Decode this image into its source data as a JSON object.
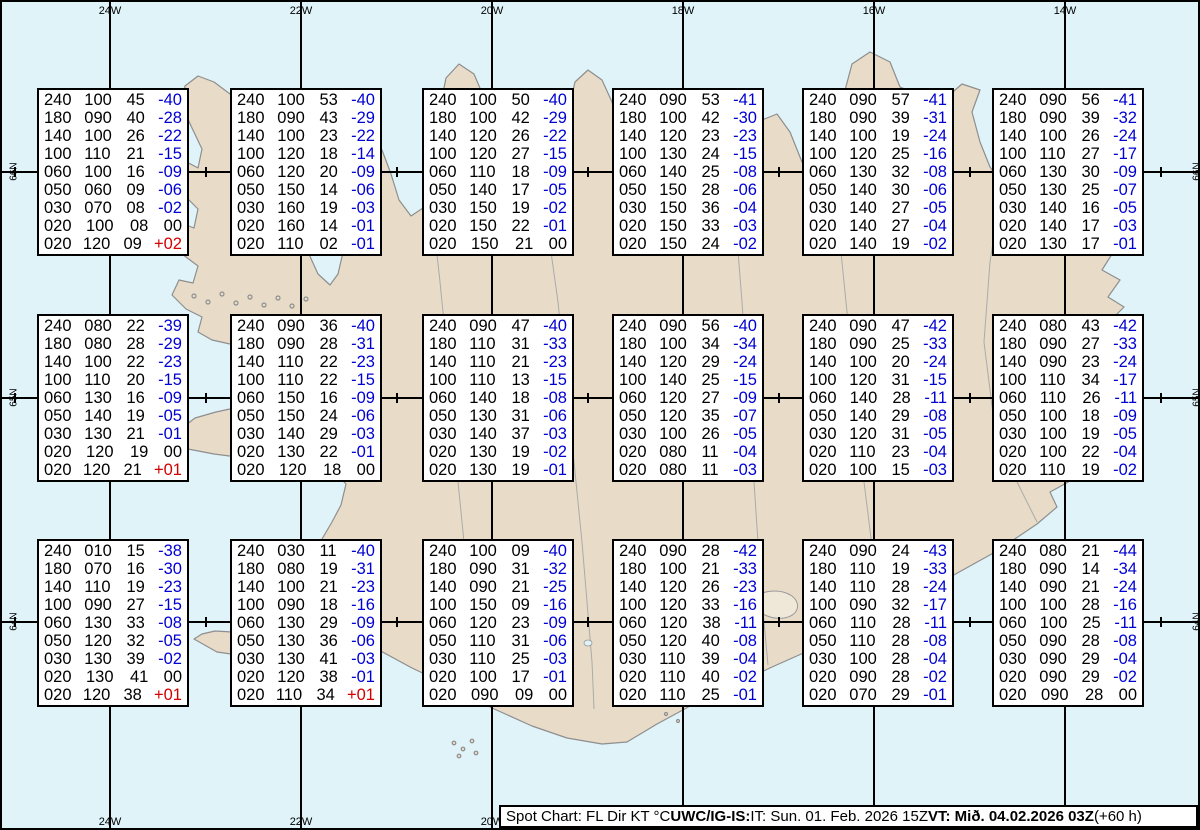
{
  "map": {
    "lon_labels": [
      "24W",
      "22W",
      "20W",
      "18W",
      "16W",
      "14W"
    ],
    "lat_labels": [
      "66N",
      "65N",
      "64N"
    ],
    "colors": {
      "sea": "#dff3f9",
      "land": "#e8dcc9",
      "coast": "#8e8e8e",
      "grid": "#000000",
      "temp_negative": "#0000d4",
      "temp_positive": "#d40000",
      "text": "#000000"
    }
  },
  "footer": {
    "segments": [
      {
        "text": "Spot Chart: FL Dir KT °C ",
        "bold": false
      },
      {
        "text": "UWC/IG-IS:",
        "bold": true
      },
      {
        "text": " IT: Sun. 01. Feb. 2026 15Z ",
        "bold": false
      },
      {
        "text": "VT: Mið. 04.02.2026 03Z",
        "bold": true
      },
      {
        "text": " (+60 h)",
        "bold": false
      }
    ]
  },
  "boxes": [
    {
      "rows": [
        [
          "240",
          "100",
          "45",
          "-40"
        ],
        [
          "180",
          "090",
          "40",
          "-28"
        ],
        [
          "140",
          "100",
          "26",
          "-22"
        ],
        [
          "100",
          "110",
          "21",
          "-15"
        ],
        [
          "060",
          "100",
          "16",
          "-09"
        ],
        [
          "050",
          "060",
          "09",
          "-06"
        ],
        [
          "030",
          "070",
          "08",
          "-02"
        ],
        [
          "020",
          "100",
          "08",
          "00"
        ],
        [
          "020",
          "120",
          "09",
          "+02"
        ]
      ]
    },
    {
      "rows": [
        [
          "240",
          "100",
          "53",
          "-40"
        ],
        [
          "180",
          "090",
          "43",
          "-29"
        ],
        [
          "140",
          "100",
          "23",
          "-22"
        ],
        [
          "100",
          "120",
          "18",
          "-14"
        ],
        [
          "060",
          "120",
          "20",
          "-09"
        ],
        [
          "050",
          "150",
          "14",
          "-06"
        ],
        [
          "030",
          "160",
          "19",
          "-03"
        ],
        [
          "020",
          "160",
          "14",
          "-01"
        ],
        [
          "020",
          "110",
          "02",
          "-01"
        ]
      ]
    },
    {
      "rows": [
        [
          "240",
          "100",
          "50",
          "-40"
        ],
        [
          "180",
          "100",
          "42",
          "-29"
        ],
        [
          "140",
          "120",
          "26",
          "-22"
        ],
        [
          "100",
          "120",
          "27",
          "-15"
        ],
        [
          "060",
          "110",
          "18",
          "-09"
        ],
        [
          "050",
          "140",
          "17",
          "-05"
        ],
        [
          "030",
          "150",
          "19",
          "-02"
        ],
        [
          "020",
          "150",
          "22",
          "-01"
        ],
        [
          "020",
          "150",
          "21",
          "00"
        ]
      ]
    },
    {
      "rows": [
        [
          "240",
          "090",
          "53",
          "-41"
        ],
        [
          "180",
          "100",
          "42",
          "-30"
        ],
        [
          "140",
          "120",
          "23",
          "-23"
        ],
        [
          "100",
          "130",
          "24",
          "-15"
        ],
        [
          "060",
          "140",
          "25",
          "-08"
        ],
        [
          "050",
          "150",
          "28",
          "-06"
        ],
        [
          "030",
          "150",
          "36",
          "-04"
        ],
        [
          "020",
          "150",
          "33",
          "-03"
        ],
        [
          "020",
          "150",
          "24",
          "-02"
        ]
      ]
    },
    {
      "rows": [
        [
          "240",
          "090",
          "57",
          "-41"
        ],
        [
          "180",
          "090",
          "39",
          "-31"
        ],
        [
          "140",
          "100",
          "19",
          "-24"
        ],
        [
          "100",
          "120",
          "25",
          "-16"
        ],
        [
          "060",
          "130",
          "32",
          "-08"
        ],
        [
          "050",
          "140",
          "30",
          "-06"
        ],
        [
          "030",
          "140",
          "27",
          "-05"
        ],
        [
          "020",
          "140",
          "27",
          "-04"
        ],
        [
          "020",
          "140",
          "19",
          "-02"
        ]
      ]
    },
    {
      "rows": [
        [
          "240",
          "090",
          "56",
          "-41"
        ],
        [
          "180",
          "090",
          "39",
          "-32"
        ],
        [
          "140",
          "100",
          "26",
          "-24"
        ],
        [
          "100",
          "110",
          "27",
          "-17"
        ],
        [
          "060",
          "130",
          "30",
          "-09"
        ],
        [
          "050",
          "130",
          "25",
          "-07"
        ],
        [
          "030",
          "140",
          "16",
          "-05"
        ],
        [
          "020",
          "140",
          "17",
          "-03"
        ],
        [
          "020",
          "130",
          "17",
          "-01"
        ]
      ]
    },
    {
      "rows": [
        [
          "240",
          "080",
          "22",
          "-39"
        ],
        [
          "180",
          "080",
          "28",
          "-29"
        ],
        [
          "140",
          "100",
          "22",
          "-23"
        ],
        [
          "100",
          "110",
          "20",
          "-15"
        ],
        [
          "060",
          "130",
          "16",
          "-09"
        ],
        [
          "050",
          "140",
          "19",
          "-05"
        ],
        [
          "030",
          "130",
          "21",
          "-01"
        ],
        [
          "020",
          "120",
          "19",
          "00"
        ],
        [
          "020",
          "120",
          "21",
          "+01"
        ]
      ]
    },
    {
      "rows": [
        [
          "240",
          "090",
          "36",
          "-40"
        ],
        [
          "180",
          "090",
          "28",
          "-31"
        ],
        [
          "140",
          "110",
          "22",
          "-23"
        ],
        [
          "100",
          "110",
          "22",
          "-15"
        ],
        [
          "060",
          "150",
          "16",
          "-09"
        ],
        [
          "050",
          "150",
          "24",
          "-06"
        ],
        [
          "030",
          "140",
          "29",
          "-03"
        ],
        [
          "020",
          "130",
          "22",
          "-01"
        ],
        [
          "020",
          "120",
          "18",
          "00"
        ]
      ]
    },
    {
      "rows": [
        [
          "240",
          "090",
          "47",
          "-40"
        ],
        [
          "180",
          "110",
          "31",
          "-33"
        ],
        [
          "140",
          "110",
          "21",
          "-23"
        ],
        [
          "100",
          "110",
          "13",
          "-15"
        ],
        [
          "060",
          "140",
          "18",
          "-08"
        ],
        [
          "050",
          "130",
          "31",
          "-06"
        ],
        [
          "030",
          "140",
          "37",
          "-03"
        ],
        [
          "020",
          "130",
          "19",
          "-02"
        ],
        [
          "020",
          "130",
          "19",
          "-01"
        ]
      ]
    },
    {
      "rows": [
        [
          "240",
          "090",
          "56",
          "-40"
        ],
        [
          "180",
          "100",
          "34",
          "-34"
        ],
        [
          "140",
          "120",
          "29",
          "-24"
        ],
        [
          "100",
          "140",
          "25",
          "-15"
        ],
        [
          "060",
          "120",
          "27",
          "-09"
        ],
        [
          "050",
          "120",
          "35",
          "-07"
        ],
        [
          "030",
          "100",
          "26",
          "-05"
        ],
        [
          "020",
          "080",
          "11",
          "-04"
        ],
        [
          "020",
          "080",
          "11",
          "-03"
        ]
      ]
    },
    {
      "rows": [
        [
          "240",
          "090",
          "47",
          "-42"
        ],
        [
          "180",
          "090",
          "25",
          "-33"
        ],
        [
          "140",
          "100",
          "20",
          "-24"
        ],
        [
          "100",
          "120",
          "31",
          "-15"
        ],
        [
          "060",
          "140",
          "28",
          "-11"
        ],
        [
          "050",
          "140",
          "29",
          "-08"
        ],
        [
          "030",
          "120",
          "31",
          "-05"
        ],
        [
          "020",
          "110",
          "23",
          "-04"
        ],
        [
          "020",
          "100",
          "15",
          "-03"
        ]
      ]
    },
    {
      "rows": [
        [
          "240",
          "080",
          "43",
          "-42"
        ],
        [
          "180",
          "090",
          "27",
          "-33"
        ],
        [
          "140",
          "090",
          "23",
          "-24"
        ],
        [
          "100",
          "110",
          "34",
          "-17"
        ],
        [
          "060",
          "110",
          "26",
          "-11"
        ],
        [
          "050",
          "100",
          "18",
          "-09"
        ],
        [
          "030",
          "100",
          "19",
          "-05"
        ],
        [
          "020",
          "100",
          "22",
          "-04"
        ],
        [
          "020",
          "110",
          "19",
          "-02"
        ]
      ]
    },
    {
      "rows": [
        [
          "240",
          "010",
          "15",
          "-38"
        ],
        [
          "180",
          "070",
          "16",
          "-30"
        ],
        [
          "140",
          "110",
          "19",
          "-23"
        ],
        [
          "100",
          "090",
          "27",
          "-15"
        ],
        [
          "060",
          "130",
          "33",
          "-08"
        ],
        [
          "050",
          "120",
          "32",
          "-05"
        ],
        [
          "030",
          "130",
          "39",
          "-02"
        ],
        [
          "020",
          "130",
          "41",
          "00"
        ],
        [
          "020",
          "120",
          "38",
          "+01"
        ]
      ]
    },
    {
      "rows": [
        [
          "240",
          "030",
          "11",
          "-40"
        ],
        [
          "180",
          "080",
          "19",
          "-31"
        ],
        [
          "140",
          "100",
          "21",
          "-23"
        ],
        [
          "100",
          "090",
          "18",
          "-16"
        ],
        [
          "060",
          "130",
          "29",
          "-09"
        ],
        [
          "050",
          "130",
          "36",
          "-06"
        ],
        [
          "030",
          "130",
          "41",
          "-03"
        ],
        [
          "020",
          "120",
          "38",
          "-01"
        ],
        [
          "020",
          "110",
          "34",
          "+01"
        ]
      ]
    },
    {
      "rows": [
        [
          "240",
          "100",
          "09",
          "-40"
        ],
        [
          "180",
          "090",
          "31",
          "-32"
        ],
        [
          "140",
          "090",
          "21",
          "-25"
        ],
        [
          "100",
          "150",
          "09",
          "-16"
        ],
        [
          "060",
          "120",
          "23",
          "-09"
        ],
        [
          "050",
          "110",
          "31",
          "-06"
        ],
        [
          "030",
          "110",
          "25",
          "-03"
        ],
        [
          "020",
          "100",
          "17",
          "-01"
        ],
        [
          "020",
          "090",
          "09",
          "00"
        ]
      ]
    },
    {
      "rows": [
        [
          "240",
          "090",
          "28",
          "-42"
        ],
        [
          "180",
          "100",
          "21",
          "-33"
        ],
        [
          "140",
          "120",
          "26",
          "-23"
        ],
        [
          "100",
          "120",
          "33",
          "-16"
        ],
        [
          "060",
          "120",
          "38",
          "-11"
        ],
        [
          "050",
          "120",
          "40",
          "-08"
        ],
        [
          "030",
          "110",
          "39",
          "-04"
        ],
        [
          "020",
          "110",
          "40",
          "-02"
        ],
        [
          "020",
          "110",
          "25",
          "-01"
        ]
      ]
    },
    {
      "rows": [
        [
          "240",
          "090",
          "24",
          "-43"
        ],
        [
          "180",
          "110",
          "19",
          "-33"
        ],
        [
          "140",
          "110",
          "28",
          "-24"
        ],
        [
          "100",
          "090",
          "32",
          "-17"
        ],
        [
          "060",
          "110",
          "28",
          "-11"
        ],
        [
          "050",
          "110",
          "28",
          "-08"
        ],
        [
          "030",
          "100",
          "28",
          "-04"
        ],
        [
          "020",
          "090",
          "28",
          "-02"
        ],
        [
          "020",
          "070",
          "29",
          "-01"
        ]
      ]
    },
    {
      "rows": [
        [
          "240",
          "080",
          "21",
          "-44"
        ],
        [
          "180",
          "090",
          "14",
          "-34"
        ],
        [
          "140",
          "090",
          "21",
          "-24"
        ],
        [
          "100",
          "100",
          "28",
          "-16"
        ],
        [
          "060",
          "100",
          "25",
          "-11"
        ],
        [
          "050",
          "090",
          "28",
          "-08"
        ],
        [
          "030",
          "090",
          "29",
          "-04"
        ],
        [
          "020",
          "090",
          "29",
          "-02"
        ],
        [
          "020",
          "090",
          "28",
          "00"
        ]
      ]
    }
  ]
}
